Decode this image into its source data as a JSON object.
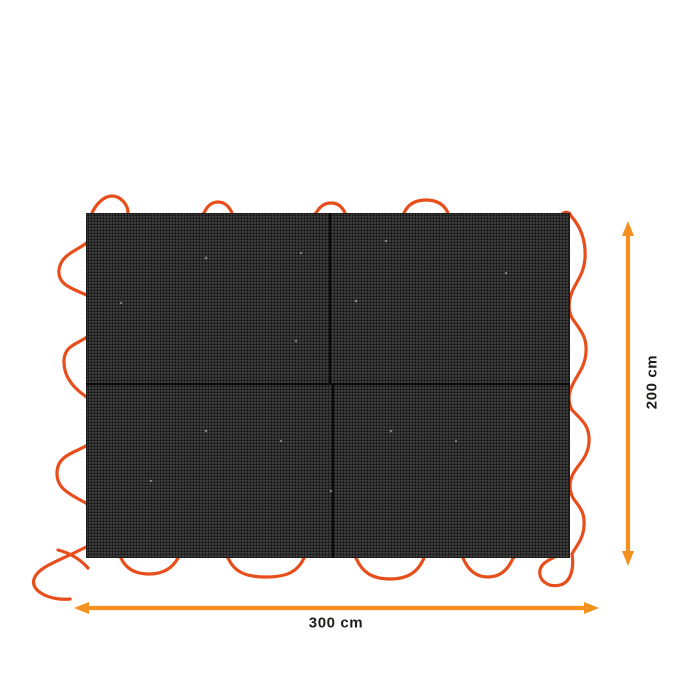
{
  "diagram": {
    "type": "product-dimension-diagram",
    "width_label": "300 cm",
    "height_label": "200 cm",
    "panels": 4
  },
  "colors": {
    "arrow": "#F4911E",
    "cord": "#E84E1B",
    "mat": "#2B2B2B",
    "label_text": "#1D1D1B",
    "background": "#FFFFFF"
  }
}
